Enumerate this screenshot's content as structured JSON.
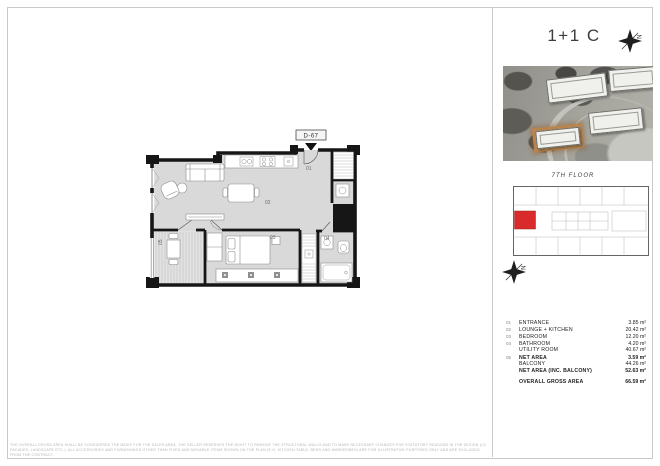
{
  "title": "1+1 C",
  "compass": {
    "letter": "N"
  },
  "key_plan": {
    "floor_label": "7TH FLOOR"
  },
  "colors": {
    "unit_highlight": "#d92b2b",
    "aerial_building_highlight": "#b9854e",
    "plan_floor": "#d9d9d9",
    "plan_wall": "#161616"
  },
  "plan": {
    "unit_label": "D-67",
    "room_labels": {
      "entrance": "01",
      "lounge": "02",
      "bedroom": "03",
      "bathroom": "04",
      "balcony": "05"
    }
  },
  "area_table": {
    "rows": [
      {
        "no": "01",
        "label": "ENTRANCE",
        "value": "3.85 m²",
        "bold": false,
        "gap": false
      },
      {
        "no": "02",
        "label": "LOUNGE + KITCHEN",
        "value": "20.42 m²",
        "bold": false,
        "gap": false
      },
      {
        "no": "03",
        "label": "BEDROOM",
        "value": "12.20 m²",
        "bold": false,
        "gap": false
      },
      {
        "no": "04",
        "label": "BATHROOM",
        "value": "4.20 m²",
        "bold": false,
        "gap": false
      },
      {
        "no": "",
        "label": "UTILITY ROOM",
        "value": "40.67 m²",
        "bold": false,
        "gap": false
      },
      {
        "no": "05",
        "label": "NET AREA",
        "value": "3.59 m²",
        "bold": true,
        "gap": false
      },
      {
        "no": "",
        "label": "BALCONY",
        "value": "44.26 m²",
        "bold": false,
        "gap": false
      },
      {
        "no": "",
        "label": "NET AREA (INC. BALCONY)",
        "value": "52.63 m²",
        "bold": true,
        "gap": false
      },
      {
        "no": "",
        "label": "OVERALL GROSS AREA",
        "value": "66.59 m²",
        "bold": true,
        "gap": true
      }
    ]
  },
  "disclaimer": {
    "line1": "THE OVERALL GROSS AREA SHALL BE CONSIDERED THE BASIS FOR THE SALES AREA. THE SELLER RESERVES THE RIGHT TO REMOVE THE STRUCTURAL WALLS AND TO MAKE NECESSARY CHANGES FOR STATUTORY REASONS IN THE DESIGN (I.E.",
    "line2": "FACADES, LANDSCAPE ETC.). ALL ACCESSORIES AND FURNISHINGS OTHER THAN FIXED AND MOVABLE ITEMS SHOWN ON THE PLAN (E.G. KITCHEN TABLE, BEDS AND WARDROBES) ARE FOR ILLUSTRATIVE PURPOSES ONLY AND ARE EXCLUDED FROM THE CONTRACT."
  }
}
